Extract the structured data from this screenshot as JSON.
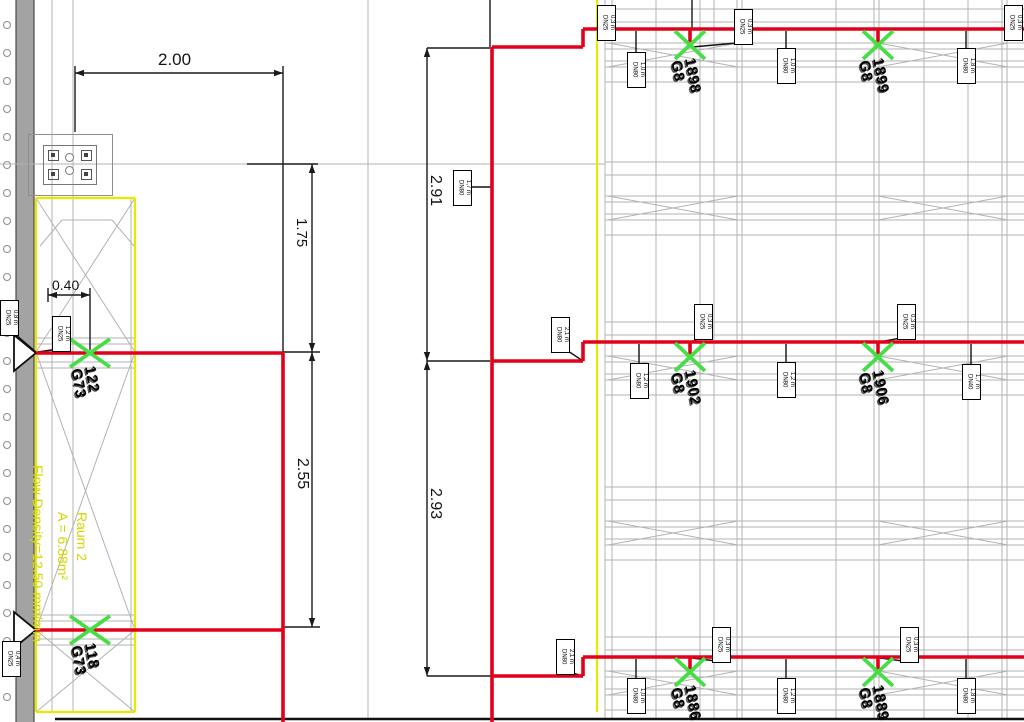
{
  "colors": {
    "pipe_red": "#e2001a",
    "sprinkler_green": "#46dd46",
    "room_yellow": "#e8e800",
    "annotation_yellow": "#d6d600",
    "rack_gray": "#b3b3b3",
    "dim_black": "#1a1a1a",
    "bar_gray": "#a3a3a3"
  },
  "annotations": {
    "room_label": "Raum 2",
    "room_area": "A = 6.88m²",
    "flow_density": "Flow Density=12.50 mm/min"
  },
  "dim_labels": [
    {
      "text": "2.00",
      "x": 158,
      "y": 50,
      "vertical": false,
      "size": 17
    },
    {
      "text": "0.40",
      "x": 52,
      "y": 277,
      "vertical": false,
      "size": 14
    },
    {
      "text": "1.75",
      "x": 293,
      "y": 218,
      "vertical": true,
      "size": 15
    },
    {
      "text": "2.55",
      "x": 293,
      "y": 458,
      "vertical": true,
      "size": 16
    },
    {
      "text": "2.91",
      "x": 426,
      "y": 175,
      "vertical": true,
      "size": 16
    },
    {
      "text": "2.93",
      "x": 426,
      "y": 488,
      "vertical": true,
      "size": 16
    }
  ],
  "sprinklers": [
    {
      "x": 90,
      "y": 353,
      "id": "122",
      "model": "G73",
      "sx": 20,
      "sy": 14
    },
    {
      "x": 90,
      "y": 630,
      "id": "118",
      "model": "G73",
      "sx": 20,
      "sy": 14
    },
    {
      "x": 690,
      "y": 45,
      "id": "1898",
      "model": "G8",
      "sx": 15,
      "sy": 14
    },
    {
      "x": 878,
      "y": 45,
      "id": "1899",
      "model": "G8",
      "sx": 15,
      "sy": 14
    },
    {
      "x": 690,
      "y": 357,
      "id": "1902",
      "model": "G8",
      "sx": 15,
      "sy": 14
    },
    {
      "x": 878,
      "y": 357,
      "id": "1906",
      "model": "G8",
      "sx": 15,
      "sy": 14
    },
    {
      "x": 690,
      "y": 672,
      "id": "1886",
      "model": "G8",
      "sx": 15,
      "sy": 14
    },
    {
      "x": 878,
      "y": 672,
      "id": "1889",
      "model": "G8",
      "sx": 15,
      "sy": 14
    }
  ],
  "tags": [
    {
      "x": 0,
      "y": 300,
      "l1": "0,8 m",
      "l2": "DN25",
      "leader": [
        15,
        334,
        36,
        352
      ]
    },
    {
      "x": 52,
      "y": 316,
      "l1": "1,2 m",
      "l2": "DN25",
      "leader": [
        58,
        349,
        38,
        352
      ]
    },
    {
      "x": 2,
      "y": 641,
      "l1": "0,4 m",
      "l2": "DN25"
    },
    {
      "x": 453,
      "y": 170,
      "l1": "1,7 m",
      "l2": "DN80",
      "leader": [
        471,
        187,
        491,
        187
      ]
    },
    {
      "x": 551,
      "y": 317,
      "l1": "2,1 m",
      "l2": "DN80",
      "leader": [
        568,
        351,
        583,
        361
      ]
    },
    {
      "x": 556,
      "y": 639,
      "l1": "2,1 m",
      "l2": "DN80",
      "leader": [
        573,
        673,
        583,
        676
      ]
    },
    {
      "x": 597,
      "y": 5,
      "l1": "0,3 m",
      "l2": "DN25"
    },
    {
      "x": 734,
      "y": 9,
      "l1": "0,3 m",
      "l2": "DN25",
      "leader": [
        737,
        43,
        692,
        47
      ]
    },
    {
      "x": 1004,
      "y": 5,
      "l1": "0,3 m",
      "l2": "DN25"
    },
    {
      "x": 627,
      "y": 52,
      "l1": "1,0 m",
      "l2": "DN80",
      "stem": [
        636,
        31,
        52
      ]
    },
    {
      "x": 777,
      "y": 48,
      "l1": "1,0 m",
      "l2": "DN80",
      "stem": [
        786,
        31,
        48
      ]
    },
    {
      "x": 957,
      "y": 48,
      "l1": "1,8 m",
      "l2": "DN80",
      "stem": [
        966,
        31,
        48
      ]
    },
    {
      "x": 694,
      "y": 304,
      "l1": "0,3 m",
      "l2": "DN25",
      "leader": [
        700,
        338,
        691,
        342
      ]
    },
    {
      "x": 897,
      "y": 304,
      "l1": "0,3 m",
      "l2": "DN25",
      "leader": [
        901,
        338,
        879,
        342
      ]
    },
    {
      "x": 630,
      "y": 363,
      "l1": "1,2 m",
      "l2": "DN80",
      "stem": [
        639,
        344,
        363
      ]
    },
    {
      "x": 777,
      "y": 362,
      "l1": "1,2 m",
      "l2": "DN80",
      "stem": [
        786,
        344,
        362
      ]
    },
    {
      "x": 962,
      "y": 364,
      "l1": "1,7 m",
      "l2": "DN40",
      "stem": [
        971,
        344,
        364
      ]
    },
    {
      "x": 712,
      "y": 627,
      "l1": "0,3 m",
      "l2": "DN25",
      "leader": [
        716,
        661,
        692,
        658
      ]
    },
    {
      "x": 900,
      "y": 627,
      "l1": "0,3 m",
      "l2": "DN25",
      "leader": [
        903,
        661,
        880,
        658
      ]
    },
    {
      "x": 627,
      "y": 678,
      "l1": "1,0 m",
      "l2": "DN80",
      "stem": [
        636,
        659,
        678
      ]
    },
    {
      "x": 777,
      "y": 678,
      "l1": "1,2 m",
      "l2": "DN80",
      "stem": [
        786,
        659,
        678
      ]
    },
    {
      "x": 957,
      "y": 678,
      "l1": "1,8 m",
      "l2": "DN80",
      "stem": [
        966,
        659,
        678
      ]
    }
  ],
  "linework": {
    "gray": [
      [
        52,
        0,
        52,
        712
      ],
      [
        73,
        0,
        73,
        712
      ],
      [
        131,
        198,
        131,
        712
      ],
      [
        0,
        164,
        605,
        164
      ],
      [
        368,
        0,
        368,
        719
      ],
      [
        36,
        338,
        135,
        338
      ],
      [
        36,
        344,
        135,
        344
      ],
      [
        36,
        362,
        135,
        362
      ],
      [
        36,
        368,
        135,
        368
      ],
      [
        36,
        615,
        135,
        615
      ],
      [
        36,
        621,
        135,
        621
      ],
      [
        36,
        639,
        135,
        639
      ],
      [
        36,
        645,
        135,
        645
      ],
      [
        36,
        198,
        135,
        352
      ],
      [
        135,
        198,
        36,
        352
      ],
      [
        36,
        352,
        135,
        630
      ],
      [
        135,
        352,
        36,
        630
      ],
      [
        36,
        630,
        135,
        712
      ],
      [
        135,
        630,
        36,
        712
      ],
      [
        40,
        246,
        62,
        220
      ],
      [
        62,
        220,
        112,
        220
      ],
      [
        112,
        220,
        134,
        246
      ]
    ],
    "yellow": [
      [
        36,
        198,
        135,
        198
      ],
      [
        36,
        198,
        36,
        712
      ],
      [
        135,
        198,
        135,
        712
      ],
      [
        36,
        712,
        135,
        712
      ],
      [
        597,
        0,
        597,
        712
      ]
    ],
    "black": [
      [
        75,
        73,
        283,
        73
      ],
      [
        75,
        66,
        75,
        132
      ],
      [
        283,
        66,
        283,
        352
      ],
      [
        48,
        295,
        90,
        295
      ],
      [
        48,
        288,
        48,
        302
      ],
      [
        90,
        288,
        90,
        350
      ],
      [
        312,
        164,
        312,
        352
      ],
      [
        247,
        164,
        318,
        164
      ],
      [
        312,
        352,
        312,
        627
      ],
      [
        283,
        352,
        320,
        352
      ],
      [
        283,
        627,
        320,
        627
      ],
      [
        427,
        48,
        427,
        361
      ],
      [
        427,
        48,
        490,
        48
      ],
      [
        427,
        361,
        490,
        361
      ],
      [
        427,
        361,
        427,
        676
      ],
      [
        427,
        676,
        492,
        676
      ],
      [
        490,
        0,
        490,
        47
      ],
      [
        692,
        0,
        692,
        29
      ]
    ],
    "red": [
      [
        36,
        353,
        283,
        353
      ],
      [
        36,
        630,
        283,
        630
      ],
      [
        283,
        353,
        283,
        722
      ],
      [
        492,
        47,
        492,
        722
      ],
      [
        492,
        47,
        583,
        47
      ],
      [
        583,
        47,
        583,
        29
      ],
      [
        583,
        29,
        1024,
        29
      ],
      [
        492,
        361,
        583,
        361
      ],
      [
        583,
        361,
        583,
        342
      ],
      [
        583,
        342,
        1024,
        342
      ],
      [
        492,
        676,
        583,
        676
      ],
      [
        583,
        676,
        583,
        657
      ],
      [
        583,
        657,
        1024,
        657
      ],
      [
        690,
        29,
        690,
        45
      ],
      [
        878,
        29,
        878,
        45
      ],
      [
        690,
        342,
        690,
        357
      ],
      [
        878,
        342,
        878,
        357
      ],
      [
        690,
        657,
        690,
        672
      ],
      [
        878,
        657,
        878,
        672
      ]
    ],
    "heavy": [
      [
        55,
        719,
        1024,
        719
      ]
    ]
  },
  "racks": {
    "x0": 605,
    "x1": 1024,
    "origins": [
      9,
      162,
      322,
      487,
      637
    ],
    "dys": [
      0,
      13,
      34,
      40,
      52,
      58,
      73
    ],
    "brace": [
      34,
      58
    ],
    "bays": [
      [
        608,
        738
      ],
      [
        878,
        1008
      ]
    ],
    "verticals": [
      605,
      612,
      656,
      700,
      714,
      737,
      742,
      836,
      874,
      879,
      924,
      968,
      1002,
      1007
    ],
    "v_y0": 0,
    "v_y1": 719
  },
  "arrows": [
    [
      75,
      73,
      "left"
    ],
    [
      283,
      73,
      "right"
    ],
    [
      48,
      295,
      "left"
    ],
    [
      90,
      295,
      "right"
    ],
    [
      312,
      164,
      "up"
    ],
    [
      312,
      352,
      "down"
    ],
    [
      312,
      352,
      "up"
    ],
    [
      312,
      627,
      "down"
    ],
    [
      427,
      48,
      "up"
    ],
    [
      427,
      361,
      "down"
    ],
    [
      427,
      361,
      "up"
    ],
    [
      427,
      676,
      "down"
    ]
  ],
  "pipe_end_arrows": [
    [
      [
        14,
        335
      ],
      [
        36,
        353
      ],
      [
        14,
        371
      ]
    ],
    [
      [
        14,
        612
      ],
      [
        36,
        630
      ],
      [
        14,
        648
      ]
    ]
  ],
  "left_strip": {
    "bar": {
      "x": 16,
      "w": 18
    },
    "circles": {
      "x": 7,
      "r": 3.5,
      "y0": 25,
      "y1": 708,
      "step": 28
    }
  }
}
